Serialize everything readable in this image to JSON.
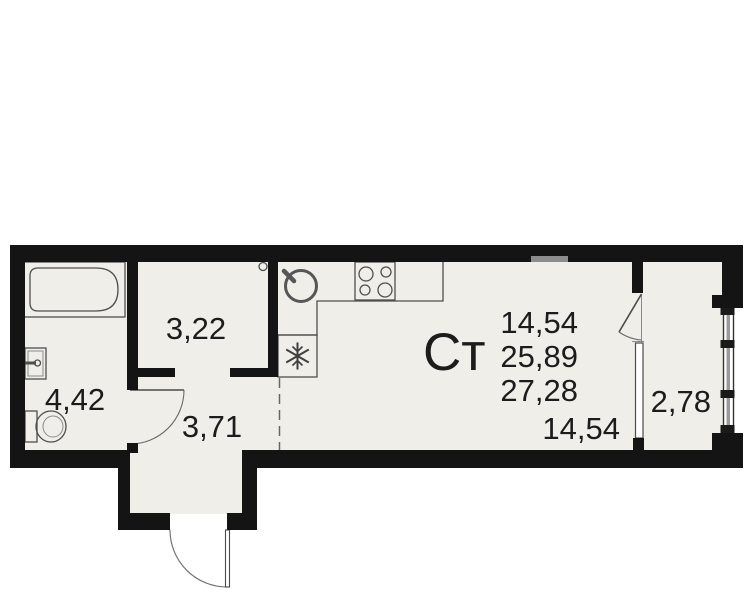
{
  "plan": {
    "unit_type": "Ст",
    "areas": {
      "bathroom": "4,42",
      "closet": "3,22",
      "hallway": "3,71",
      "living": "14,54",
      "total": "25,89",
      "total_with_balcony": "27,28",
      "main_room": "14,54",
      "balcony": "2,78"
    },
    "fixtures": [
      "bathtub",
      "bathroom-sink",
      "toilet",
      "kitchen-sink",
      "stove",
      "fridge-snowflake",
      "kitchen-counter",
      "vent-circle",
      "bathroom-door",
      "entrance-door",
      "balcony-door",
      "balcony-window",
      "balcony-glazing",
      "zone-dashed-line",
      "wall-niche"
    ],
    "colors": {
      "wall": "#141414",
      "floor": "#efeee9",
      "outline": "#4f4f4f",
      "background": "#ffffff",
      "glass": "#9a9a9a",
      "niche": "#8c8c8c",
      "text": "#1c1c1c"
    }
  }
}
